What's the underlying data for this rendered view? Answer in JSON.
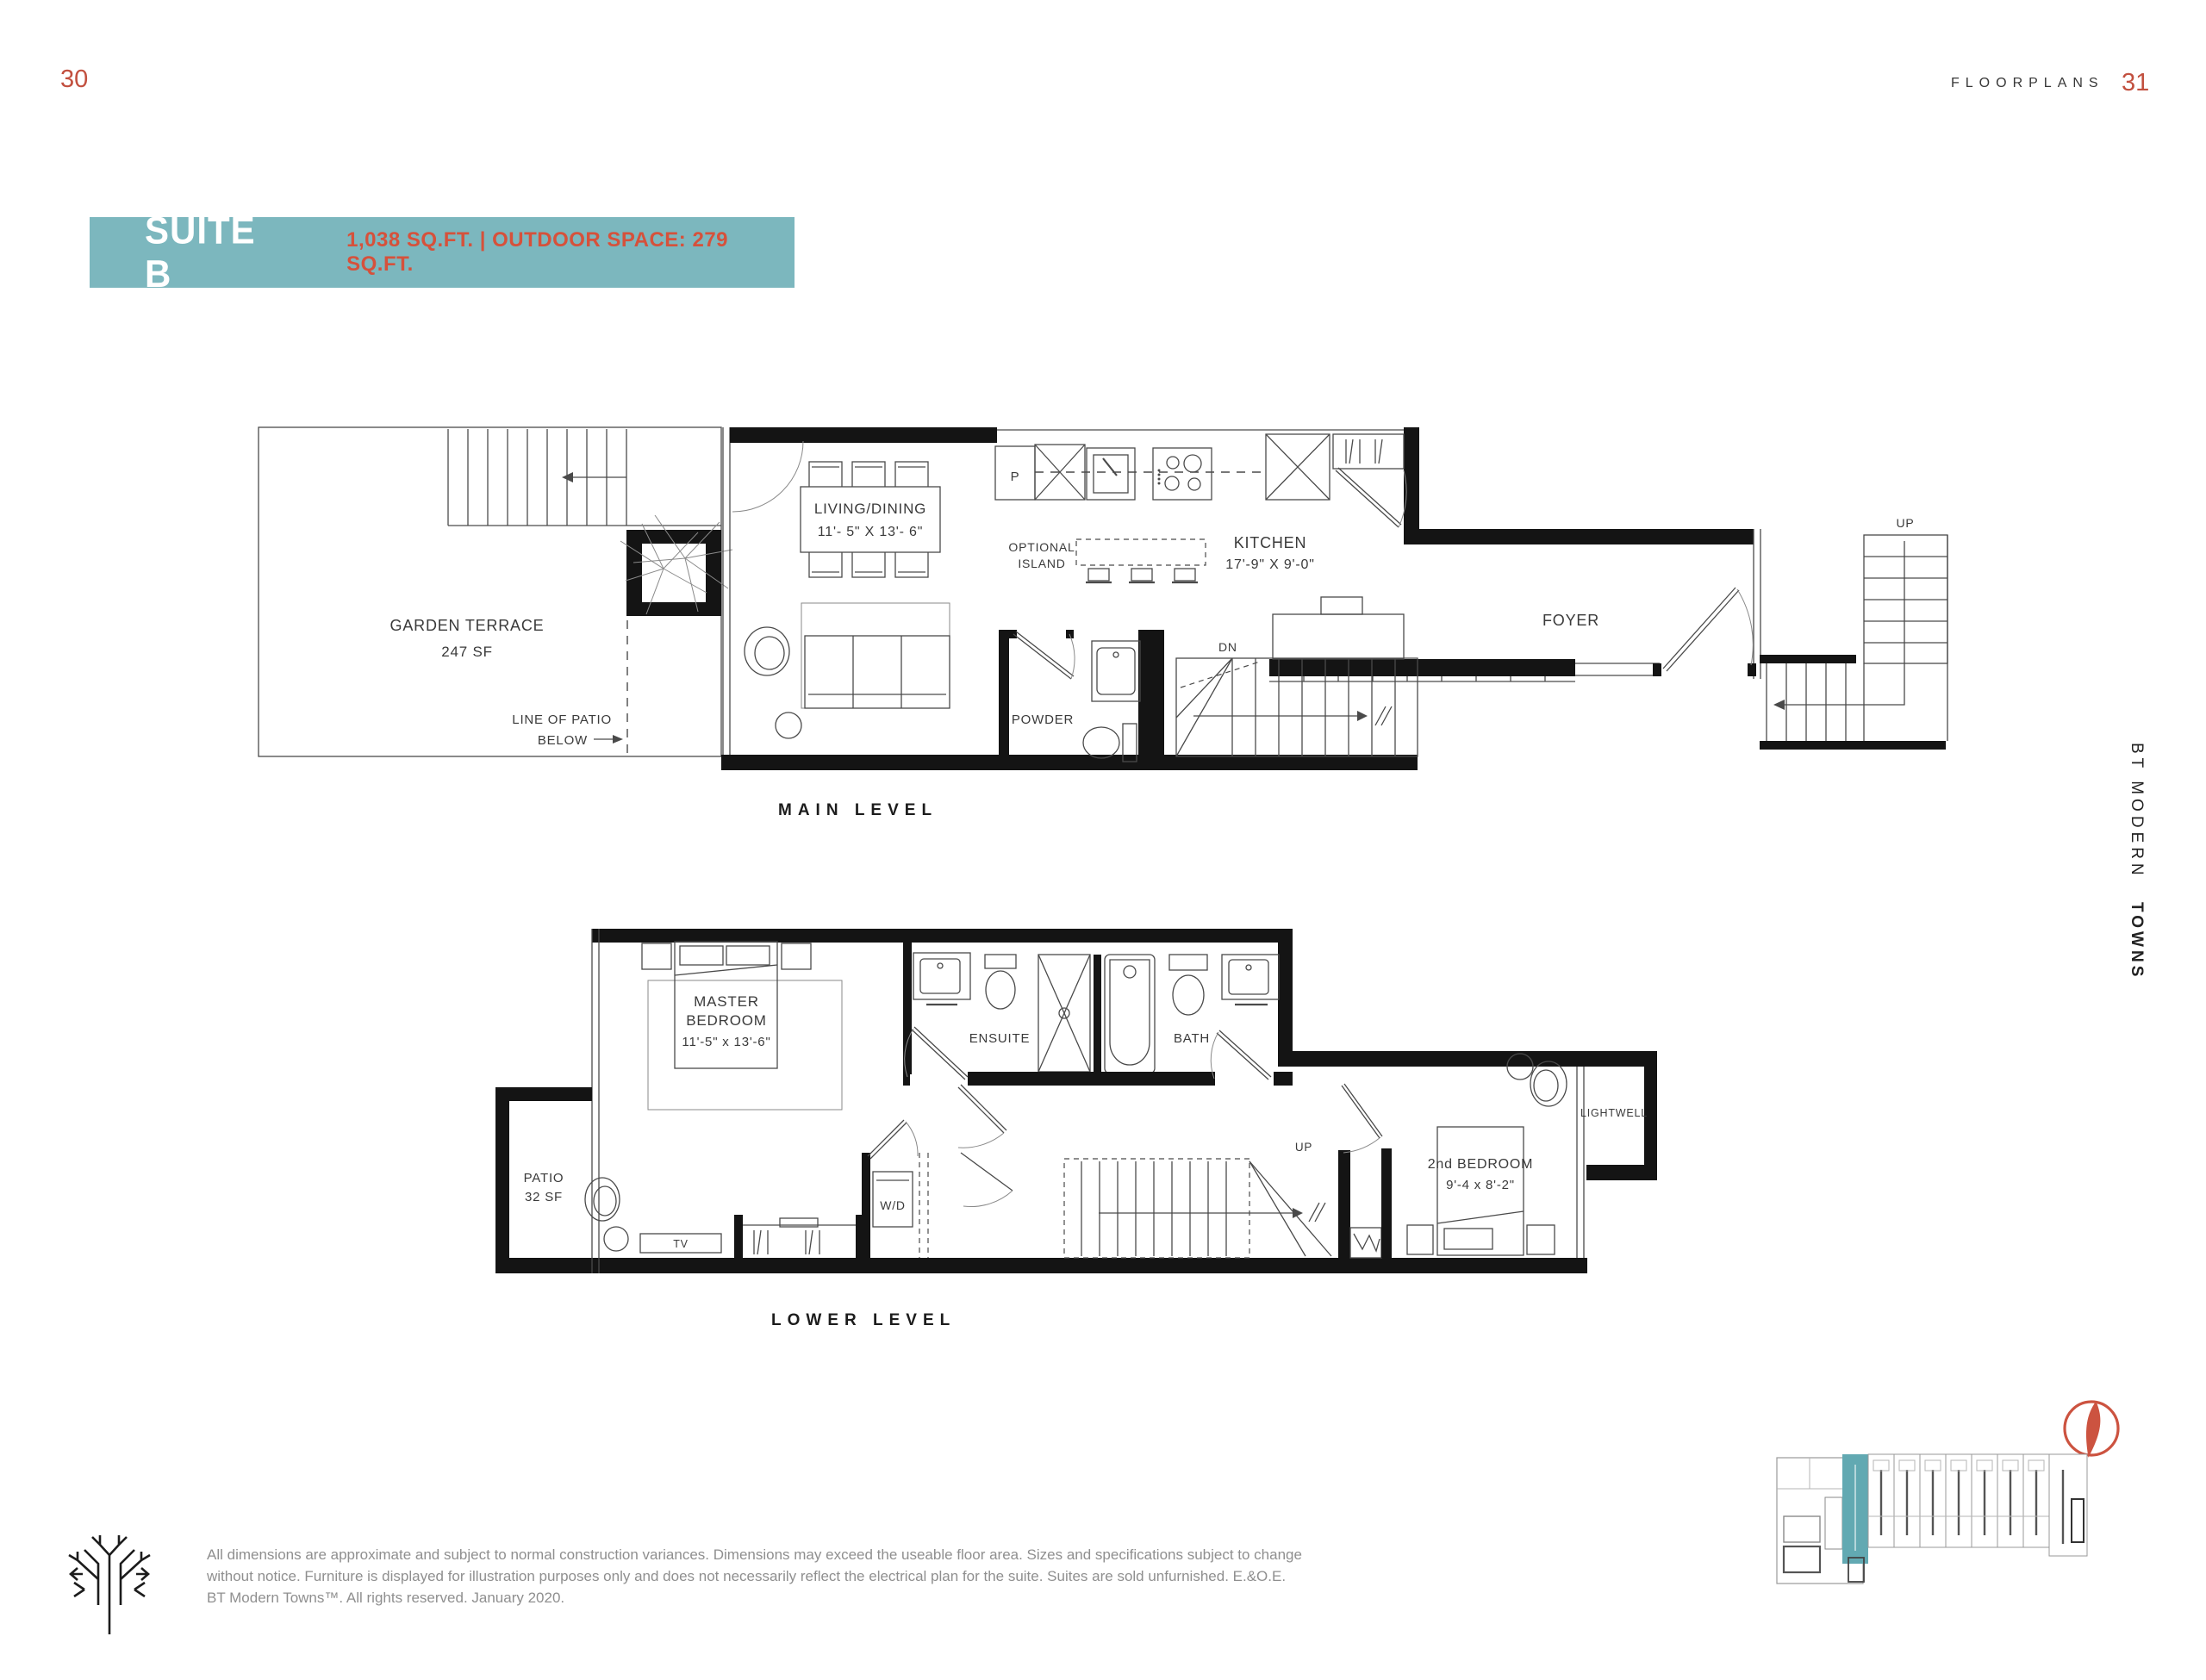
{
  "page": {
    "left_number": "30",
    "right_number": "31",
    "header_label": "FLOORPLANS"
  },
  "banner": {
    "suite_name": "SUITE B",
    "details": "1,038 SQ.FT. | OUTDOOR SPACE: 279 SQ.FT."
  },
  "colors": {
    "accent_red": "#c2503f",
    "banner_teal": "#7cb7be",
    "banner_details_red": "#d6513b",
    "wall_black": "#141414",
    "keyplan_highlight_teal": "#62a9b2",
    "compass_red": "#cc5340",
    "disclaimer_grey": "#8f8f8f"
  },
  "main_level": {
    "caption": "MAIN LEVEL",
    "garden_terrace_line1": "GARDEN TERRACE",
    "garden_terrace_line2": "247 SF",
    "patio_note_line1": "LINE OF PATIO",
    "patio_note_line2": "BELOW",
    "living_dining_line1": "LIVING/DINING",
    "living_dining_line2": "11'- 5\" X 13'- 6\"",
    "pantry": "P",
    "optional_island_line1": "OPTIONAL",
    "optional_island_line2": "ISLAND",
    "kitchen_line1": "KITCHEN",
    "kitchen_line2": "17'-9\" X 9'-0\"",
    "foyer": "FOYER",
    "powder": "POWDER",
    "stairs_down": "DN",
    "stairs_up": "UP"
  },
  "lower_level": {
    "caption": "LOWER LEVEL",
    "master_line1": "MASTER",
    "master_line2": "BEDROOM",
    "master_line3": "11'-5\" x 13'-6\"",
    "ensuite": "ENSUITE",
    "bath": "BATH",
    "patio_line1": "PATIO",
    "patio_line2": "32 SF",
    "washer_dryer": "W/D",
    "tv": "TV",
    "stairs_up": "UP",
    "second_bedroom_line1": "2nd BEDROOM",
    "second_bedroom_line2": "9'-4 x 8'-2\"",
    "lightwell": "LIGHTWELL"
  },
  "sidebar": {
    "brand_regular": "BT MODERN",
    "brand_bold": "TOWNS"
  },
  "footer": {
    "disclaimer_line1": "All dimensions are approximate and subject to normal construction variances. Dimensions may exceed the useable floor area. Sizes and specifications subject to change",
    "disclaimer_line2": "without notice. Furniture is displayed for illustration purposes only and does not necessarily reflect the electrical plan for the suite. Suites are sold unfurnished. E.&O.E.",
    "disclaimer_line3": "BT Modern Towns™. All rights reserved. January 2020."
  }
}
